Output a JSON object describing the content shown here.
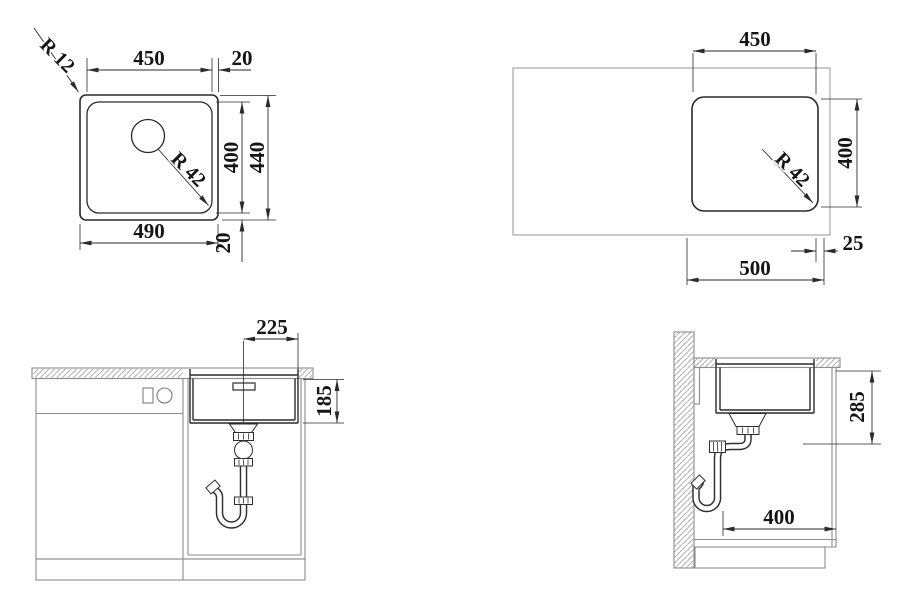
{
  "drawing": {
    "plan_sink": {
      "inner_width": "450",
      "rim_right": "20",
      "outer_radius": "R 12",
      "bowl_radius": "R 42",
      "inner_height": "400",
      "outer_height": "440",
      "outer_width": "490",
      "rim_bottom": "20"
    },
    "plan_cutout": {
      "cutout_width": "450",
      "cutout_height": "400",
      "corner_radius": "R 42",
      "edge_clearance": "25",
      "cabinet_span": "500"
    },
    "front_elevation": {
      "center_to_edge": "225",
      "bowl_depth": "185"
    },
    "side_elevation": {
      "installation_depth": "285",
      "rear_clearance": "400"
    }
  },
  "colors": {
    "product_line": "#2a2a2a",
    "furniture_line": "#8d8d8d",
    "hatch_line": "#a3a3a3",
    "background": "#ffffff"
  }
}
